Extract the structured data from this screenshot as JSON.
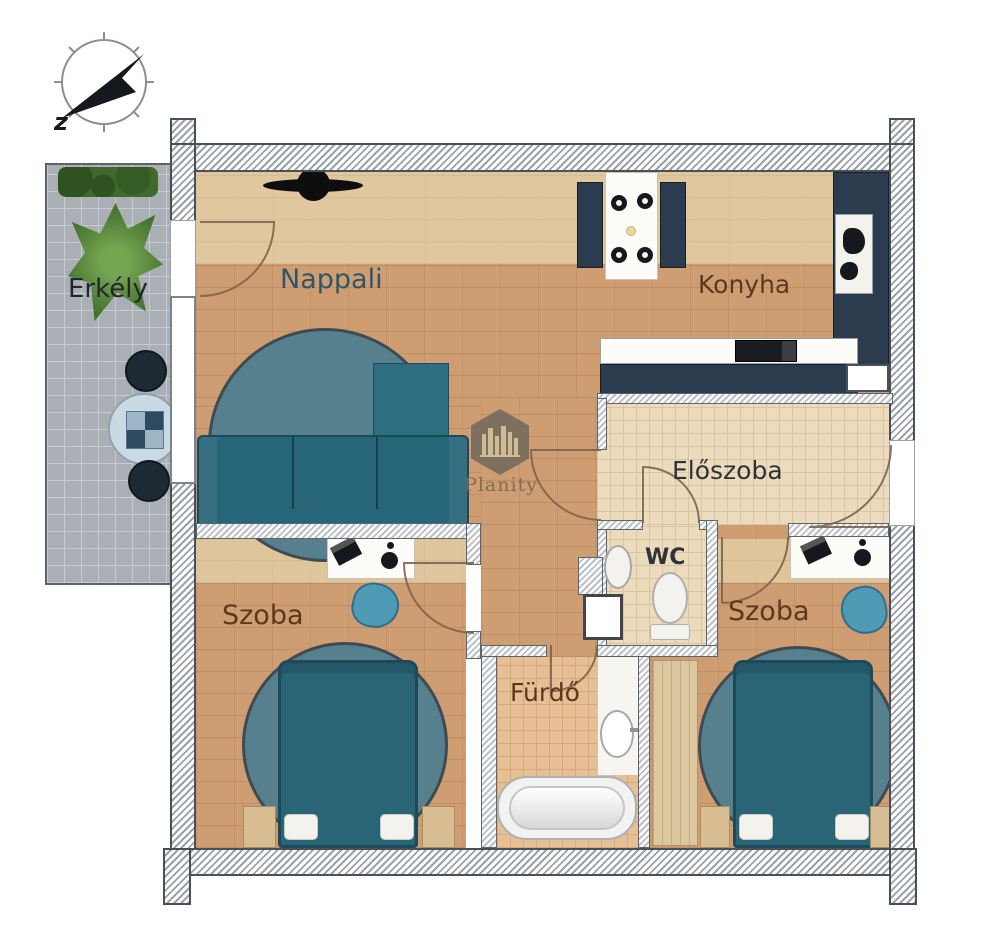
{
  "compass": {
    "letter": "z"
  },
  "watermark": {
    "brand": "Planity"
  },
  "rooms": {
    "balcony": {
      "label": "Erkély"
    },
    "living_room": {
      "label": "Nappali"
    },
    "kitchen": {
      "label": "Konyha"
    },
    "hallway": {
      "label": "Előszoba"
    },
    "wc": {
      "label": "WC"
    },
    "bedroom_left": {
      "label": "Szoba"
    },
    "bedroom_right": {
      "label": "Szoba"
    },
    "bathroom": {
      "label": "Fürdő"
    }
  },
  "colors": {
    "wood": "#cf9d72",
    "wood_light": "#e3cfa6",
    "tile_cream": "#ecdcbd",
    "tile_cream_line": "#d9c5a1",
    "tile_bath": "#e7bf94",
    "tile_bath_line": "#d5a87c",
    "balcony": "#a9afb5",
    "balcony_line": "#c6cbd0",
    "wall_stripe": "#9aa1a8",
    "wall_border": "#4b5057",
    "navy": "#2b3c4e",
    "sofa_teal": "#276579",
    "chaise_teal": "#2d6e80",
    "bed_teal": "#2a6477",
    "rug_teal": "#57808f",
    "beanbag_blue": "#4f9ab5",
    "plant_green": "#4e7d35",
    "hedge_green": "#3f6a2c",
    "wardrobe_tan": "#dcc7a0",
    "label_brown": "#5a3a1f",
    "label_dark": "#2e333a",
    "label_teal": "#2f5668",
    "door_arc": "#7a6550"
  }
}
